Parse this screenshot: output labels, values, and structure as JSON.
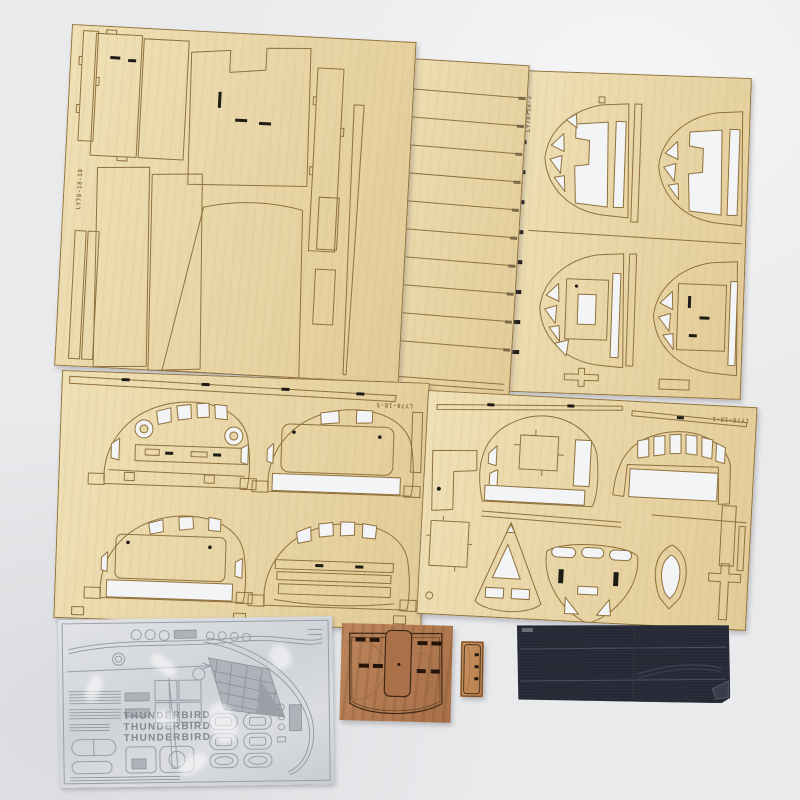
{
  "colors": {
    "background": "#e9eaec",
    "plywood_light": "#efe0b6",
    "plywood_shade": "#e2cb97",
    "cut_line": "#8f713d",
    "foam_white": "#f3f4f6",
    "slot_black": "#1f1c17",
    "dark_wood": "#b27c52",
    "dark_wood_line": "#4a2f1a",
    "small_wood": "#c28a5c",
    "black_sheet": "#262935",
    "black_sheet_line": "#4c5160",
    "decal_silver": "#d5d7db",
    "decal_line": "#999fa8",
    "decal_text": "#83888f"
  },
  "sheets": {
    "top_left": {
      "code": "LY78-18-10"
    },
    "top_middle": {
      "code": "LY78-18-3"
    },
    "top_right": {
      "code": "LY78-18-2"
    },
    "mid_left": {
      "code": "LY78-18-5"
    },
    "mid_right": {
      "code": "LY78-18-1"
    }
  },
  "decal_sheet": {
    "brand_lines": [
      "THUNDERBIRD",
      "THUNDERBIRD",
      "THUNDERBIRD"
    ]
  }
}
